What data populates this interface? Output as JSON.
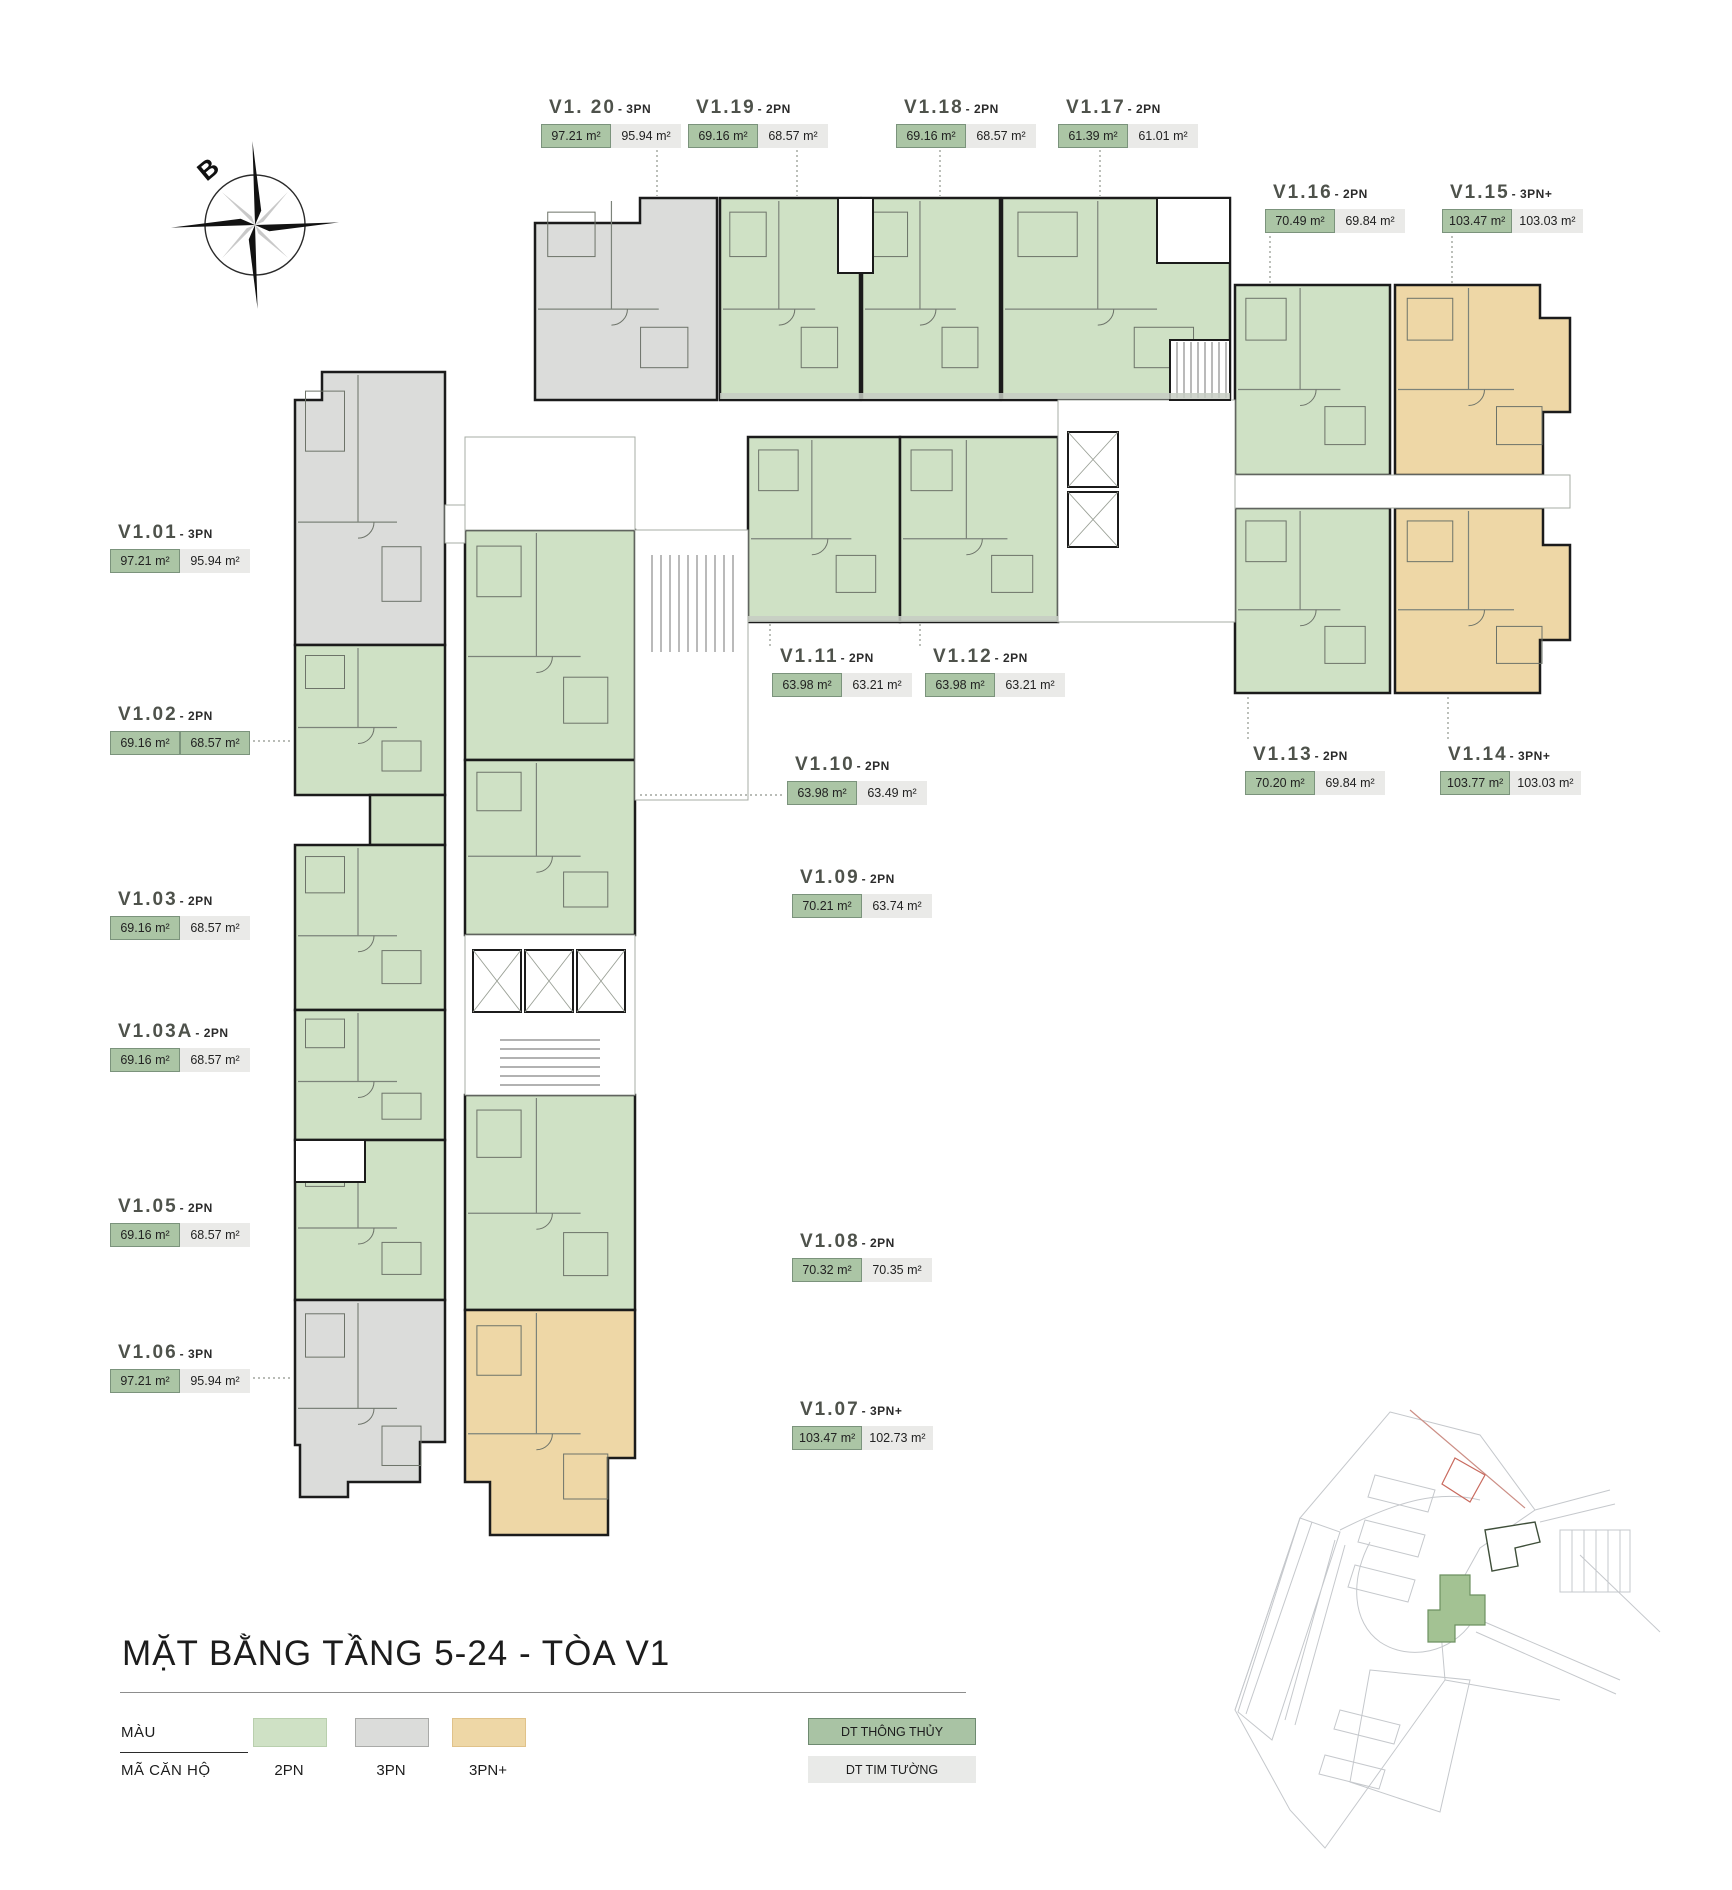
{
  "page": {
    "title": "MẶT BẰNG TẦNG 5-24 - TÒA V1"
  },
  "compass": {
    "north_label": "B"
  },
  "legend": {
    "rows": {
      "color": "MÀU",
      "code": "MÃ CĂN HỘ"
    },
    "types": [
      {
        "label": "2PN",
        "color": "#cfe1c5"
      },
      {
        "label": "3PN",
        "color": "#dbdcda"
      },
      {
        "label": "3PN+",
        "color": "#eed7a6"
      }
    ],
    "area_keys": [
      {
        "label": "DT THÔNG THỦY",
        "color": "#a9c3a4"
      },
      {
        "label": "DT TIM TƯỜNG",
        "color": "#e9eae8"
      }
    ]
  },
  "units": [
    {
      "code": "V1.01",
      "suffix": "- 3PN",
      "net": "97.21 m²",
      "gross": "95.94 m²"
    },
    {
      "code": "V1.02",
      "suffix": "- 2PN",
      "net": "69.16 m²",
      "gross": "68.57 m²"
    },
    {
      "code": "V1.03",
      "suffix": "- 2PN",
      "net": "69.16 m²",
      "gross": "68.57 m²"
    },
    {
      "code": "V1.03A",
      "suffix": "- 2PN",
      "net": "69.16 m²",
      "gross": "68.57 m²"
    },
    {
      "code": "V1.05",
      "suffix": "- 2PN",
      "net": "69.16 m²",
      "gross": "68.57 m²"
    },
    {
      "code": "V1.06",
      "suffix": "- 3PN",
      "net": "97.21 m²",
      "gross": "95.94 m²"
    },
    {
      "code": "V1.07",
      "suffix": "- 3PN+",
      "net": "103.47 m²",
      "gross": "102.73 m²"
    },
    {
      "code": "V1.08",
      "suffix": "- 2PN",
      "net": "70.32 m²",
      "gross": "70.35 m²"
    },
    {
      "code": "V1.09",
      "suffix": "- 2PN",
      "net": "70.21 m²",
      "gross": "63.74 m²"
    },
    {
      "code": "V1.10",
      "suffix": "- 2PN",
      "net": "63.98 m²",
      "gross": "63.49 m²"
    },
    {
      "code": "V1.11",
      "suffix": "- 2PN",
      "net": "63.98 m²",
      "gross": "63.21 m²"
    },
    {
      "code": "V1.12",
      "suffix": "- 2PN",
      "net": "63.98 m²",
      "gross": "63.21 m²"
    },
    {
      "code": "V1.13",
      "suffix": "- 2PN",
      "net": "70.20 m²",
      "gross": "69.84 m²"
    },
    {
      "code": "V1.14",
      "suffix": "- 3PN+",
      "net": "103.77 m²",
      "gross": "103.03 m²"
    },
    {
      "code": "V1.15",
      "suffix": "- 3PN+",
      "net": "103.47 m²",
      "gross": "103.03 m²"
    },
    {
      "code": "V1.16",
      "suffix": "- 2PN",
      "net": "70.49 m²",
      "gross": "69.84 m²"
    },
    {
      "code": "V1.17",
      "suffix": "- 2PN",
      "net": "61.39 m²",
      "gross": "61.01 m²"
    },
    {
      "code": "V1.18",
      "suffix": "- 2PN",
      "net": "69.16 m²",
      "gross": "68.57 m²"
    },
    {
      "code": "V1.19",
      "suffix": "- 2PN",
      "net": "69.16 m²",
      "gross": "68.57 m²"
    },
    {
      "code": "V1. 20",
      "suffix": "- 3PN",
      "net": "97.21 m²",
      "gross": "95.94 m²"
    }
  ]
}
